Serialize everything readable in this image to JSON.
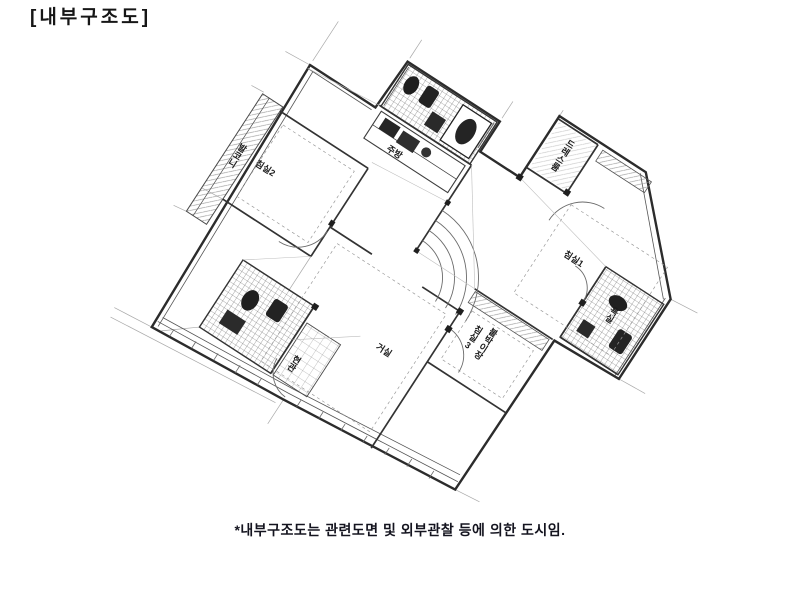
{
  "header": {
    "title": "[내부구조도]"
  },
  "footnote": {
    "text": "*내부구조도는 관련도면 및 외부관찰 등에 의한 도시임."
  },
  "floor_plan": {
    "rotation_deg": 33,
    "ink_color": "#3b3b3b",
    "rooms": [
      {
        "id": "bedroom2",
        "label": "침실2"
      },
      {
        "id": "balcony-left",
        "label": "발코니"
      },
      {
        "id": "kitchen",
        "label": "주방"
      },
      {
        "id": "dress-room",
        "label": "드레스룸"
      },
      {
        "id": "bedroom1",
        "label": "침실1"
      },
      {
        "id": "living-room",
        "label": "거실"
      },
      {
        "id": "built-in-closet",
        "label": "붙박이장"
      },
      {
        "id": "bedroom3",
        "label": "침실3"
      },
      {
        "id": "bathroom",
        "label": "욕실"
      },
      {
        "id": "entrance",
        "label": "현관"
      }
    ]
  }
}
